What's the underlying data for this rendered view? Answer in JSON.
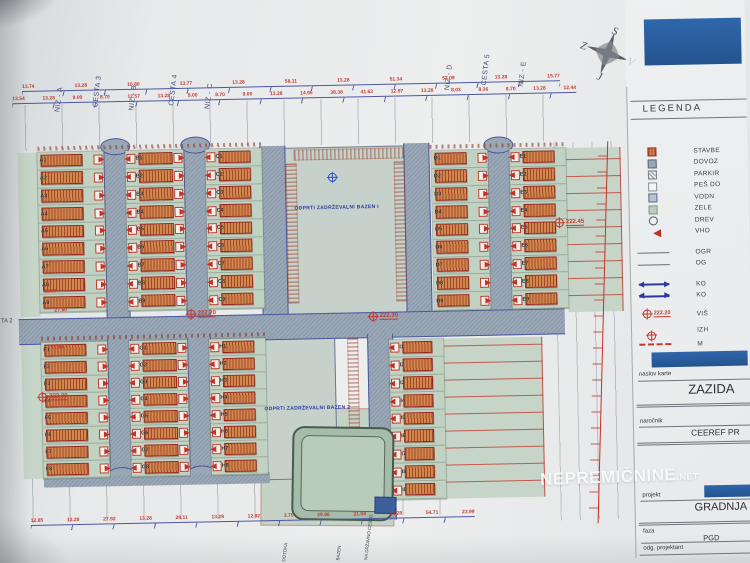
{
  "compass": {
    "north": "S",
    "south": "J",
    "west": "Z",
    "east": "V"
  },
  "street_labels": [
    {
      "text": "NIZ - A",
      "x": 62,
      "top": 44
    },
    {
      "text": "CESTA 3",
      "x": 100,
      "top": 40
    },
    {
      "text": "NIZ - B",
      "x": 136,
      "top": 44
    },
    {
      "text": "CESTA 4",
      "x": 176,
      "top": 40
    },
    {
      "text": "NIZ - C",
      "x": 212,
      "top": 44
    },
    {
      "text": "NIZ - D",
      "x": 452,
      "top": 30
    },
    {
      "text": "CESTA 5",
      "x": 489,
      "top": 26
    },
    {
      "text": "NIZ - E",
      "x": 526,
      "top": 28
    }
  ],
  "dimensions": {
    "top_row_1": [
      "13.74",
      "13.28",
      "10.80",
      "13.77",
      "13.28",
      "58.11",
      "13.28",
      "51.34",
      "53.09",
      "13.28",
      "15.77"
    ],
    "top_row_2": [
      "13.54",
      "13.28",
      "9.00",
      "8.70",
      "12.57",
      "13.28",
      "9.00",
      "8.70",
      "9.00",
      "13.28",
      "14.95",
      "38.38",
      "41.63",
      "12.97",
      "13.28",
      "8.03",
      "8.36",
      "8.70",
      "13.28",
      "12.44"
    ],
    "bottom_row": [
      "12.85",
      "13.28",
      "27.92",
      "13.28",
      "28.11",
      "13.28",
      "12.92",
      "3.75",
      "29.86",
      "21.58",
      "13.28",
      "54.71",
      "23.99"
    ],
    "left_side": [
      "18.67",
      "27.60",
      "11.46"
    ]
  },
  "elevation_markers": [
    {
      "value": "222.20",
      "x": 186,
      "y": 306
    },
    {
      "value": "222.30",
      "x": 368,
      "y": 312
    },
    {
      "value": "222.45",
      "x": 556,
      "y": 222
    },
    {
      "value": "222.30",
      "x": 36,
      "y": 386
    }
  ],
  "origin_markers": [
    {
      "x": 330,
      "y": 168
    }
  ],
  "areas": {
    "basin1": "ODPRTI ZADRŽEVALNI BAZEN I",
    "basin2": "ODPRTI ZADRŽEVALNI BAZEN 2"
  },
  "bottom_labels": [
    {
      "text": "DOTOKA",
      "x": 280
    },
    {
      "text": "BAZEN",
      "x": 334
    },
    {
      "text": "NA DRŽAVNO CESTO",
      "x": 362
    }
  ],
  "left_edge_label": "TA 2",
  "blocks": [
    {
      "id": "A",
      "x": 40,
      "y": 146,
      "w": 66,
      "h": 160,
      "side": "right",
      "labels": [
        "A1",
        "A2",
        "A3",
        "A4",
        "A5",
        "A6",
        "A7",
        "A8",
        "A9"
      ]
    },
    {
      "id": "B",
      "x": 128,
      "y": 146,
      "w": 58,
      "h": 160,
      "side": "both",
      "labels": [
        "B1",
        "B2",
        "B3",
        "B4",
        "B5",
        "B6",
        "B7",
        "B8",
        "B9"
      ]
    },
    {
      "id": "C",
      "x": 208,
      "y": 146,
      "w": 56,
      "h": 160,
      "side": "left",
      "labels": [
        "C1",
        "C2",
        "C3",
        "C4",
        "C5",
        "C6",
        "C7",
        "C8",
        "C9"
      ]
    },
    {
      "id": "D",
      "x": 434,
      "y": 152,
      "w": 56,
      "h": 160,
      "side": "right",
      "labels": [
        "D1",
        "D2",
        "D3",
        "D4",
        "D5",
        "D6",
        "D7",
        "D8",
        "D9"
      ]
    },
    {
      "id": "E",
      "x": 512,
      "y": 152,
      "w": 56,
      "h": 160,
      "side": "left",
      "labels": [
        "E1",
        "E2",
        "E3",
        "E4",
        "E5",
        "E6",
        "E7",
        "E8",
        "E9"
      ]
    },
    {
      "id": "F",
      "x": 40,
      "y": 336,
      "w": 66,
      "h": 136,
      "side": "right",
      "labels": [
        "F1",
        "F2",
        "F3",
        "F4",
        "F5",
        "F6",
        "F7",
        "F8"
      ]
    },
    {
      "id": "G",
      "x": 128,
      "y": 336,
      "w": 58,
      "h": 136,
      "side": "both",
      "labels": [
        "G1",
        "G2",
        "G3",
        "G4",
        "G5",
        "G6",
        "G7",
        "G8"
      ]
    },
    {
      "id": "H",
      "x": 208,
      "y": 336,
      "w": 56,
      "h": 136,
      "side": "left",
      "labels": [
        "H1",
        "H2",
        "H3",
        "H4",
        "H5",
        "H6",
        "H7",
        "H8"
      ]
    },
    {
      "id": "I",
      "x": 388,
      "y": 340,
      "w": 54,
      "h": 160,
      "side": "left",
      "labels": [
        "I1",
        "I2",
        "I3",
        "I4",
        "I5",
        "I6",
        "I7",
        "I8",
        "I9"
      ]
    }
  ],
  "legend": {
    "title": "LEGENDA",
    "sample_elevation": "222.20",
    "items": [
      {
        "type": "building",
        "label": "STAVBE"
      },
      {
        "type": "road",
        "label": "DOVOZ"
      },
      {
        "type": "parking",
        "label": "PARKIR"
      },
      {
        "type": "path",
        "label": "PEŠ DO"
      },
      {
        "type": "water",
        "label": "VODN"
      },
      {
        "type": "green",
        "label": "ZELE"
      },
      {
        "type": "tree",
        "label": "DREV"
      },
      {
        "type": "entry",
        "label": "VHO"
      },
      {
        "type": "line",
        "label": "OGR",
        "gap": 9
      },
      {
        "type": "line",
        "label": "OG"
      },
      {
        "type": "arrow",
        "label": "KO",
        "gap": 9
      },
      {
        "type": "arrow",
        "label": "KO"
      },
      {
        "type": "elev",
        "label": "VIŠ",
        "gap": 7
      },
      {
        "type": "origin",
        "label": "IZH",
        "gap": 5
      },
      {
        "type": "dashed",
        "label": "M",
        "gap": 2
      }
    ]
  },
  "titleblock": {
    "naslov_karte_label": "naslov karte",
    "naslov_karte_value": "ZAZIDA",
    "narocnik_label": "naročnik",
    "narocnik_value": "CEEREF PR",
    "projekt_label": "projekt",
    "projekt_value": "GRADNJA",
    "faza_label": "faza",
    "faza_value": "PGD",
    "odg_label": "odg. projektant"
  },
  "watermark": {
    "text": "NEPREMIČNINE",
    "suffix": ".NET"
  }
}
